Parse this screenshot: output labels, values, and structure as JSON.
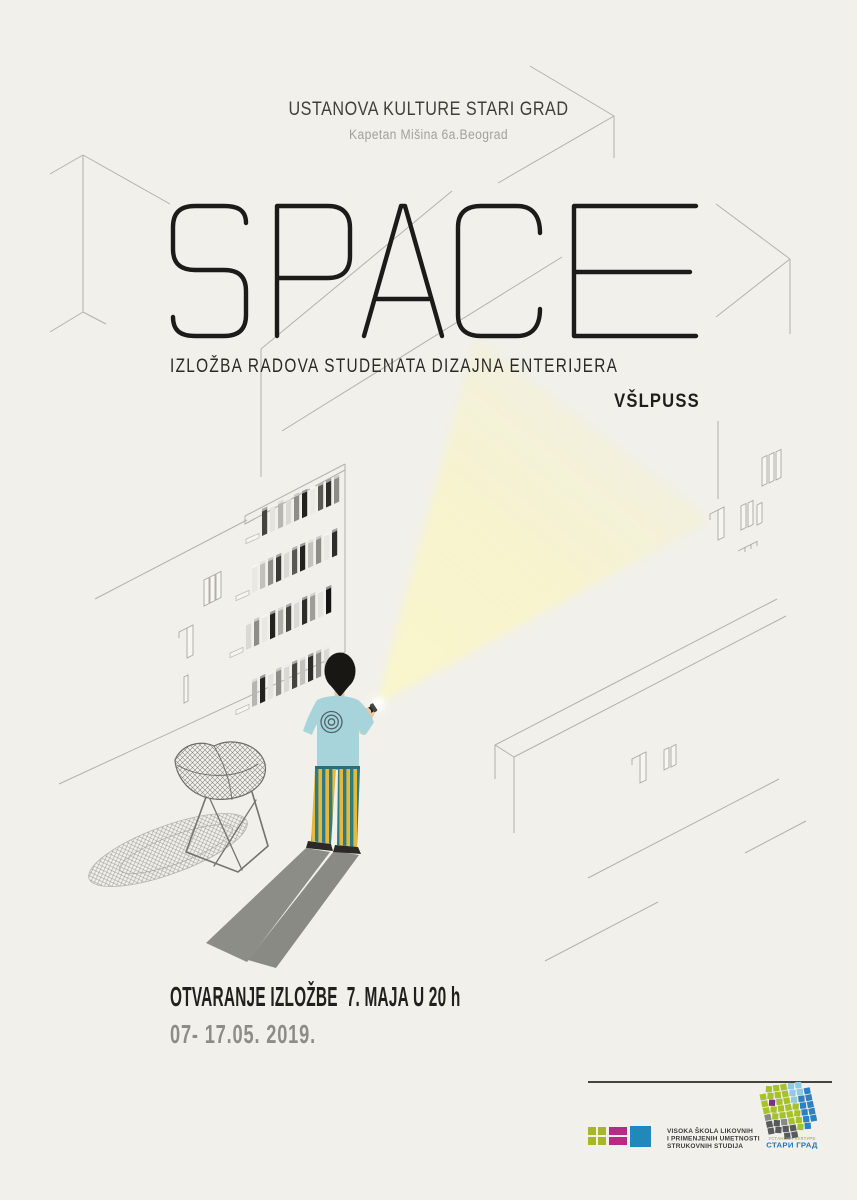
{
  "poster": {
    "venue": "USTANOVA KULTURE STARI GRAD",
    "address": "Kapetan Mišina 6a.Beograd",
    "title": "SPACE",
    "subtitle": "IZLOŽBA RADOVA STUDENATA DIZAJNA ENTERIJERA",
    "organizer": "VŠLPUSS",
    "opening_line": "OTVARANJE IZLOŽBE  7. MAJA U 20 h",
    "dates_line": "07- 17.05. 2019."
  },
  "colors": {
    "background": "#f1f0ea",
    "ink": "#1c1b19",
    "line_gray": "#b3b1ab",
    "muted_text": "#8d8c87",
    "beam_yellow": "#f8f4c8"
  },
  "illustration": {
    "figure": {
      "hair": "#181714",
      "skin": "#e9c79e",
      "shirt": "#a7d4da",
      "emblem_ring": "#4e6367",
      "stripe_teal": "#2a7d84",
      "stripe_yellow": "#e6b93e",
      "shoes": "#2b2a26",
      "shadow": "#8d8d88",
      "flashlight": "#1d1d1b"
    },
    "bookshelf": {
      "rows": [
        {
          "x": 262,
          "y": 536,
          "books": [
            "#45443f",
            "#e4e3de",
            "#b7b6b1",
            "#dad9d4",
            "#8e8d88",
            "#22221e",
            "#ebeae5",
            "#5a5954",
            "#2d2d29",
            "#8e8d88"
          ]
        },
        {
          "x": 252,
          "y": 593,
          "books": [
            "#e9e8e3",
            "#c2c1bc",
            "#8e8d88",
            "#3a3935",
            "#dad9d4",
            "#5a5954",
            "#22221e",
            "#c2c1bc",
            "#8e8d88",
            "#e9e8e3",
            "#2d2d29"
          ]
        },
        {
          "x": 246,
          "y": 650,
          "books": [
            "#dad9d4",
            "#8e8d88",
            "#e9e8e3",
            "#22221e",
            "#aeada8",
            "#45443f",
            "#dad9d4",
            "#2d2d29",
            "#9e9d98",
            "#e4e3de",
            "#141412"
          ]
        },
        {
          "x": 252,
          "y": 707,
          "books": [
            "#b7b6b1",
            "#22221e",
            "#e4e3de",
            "#8e8d88",
            "#dad9d4",
            "#45443f",
            "#c2c1bc",
            "#2d2d29",
            "#8e8d88",
            "#dad9d4"
          ]
        }
      ]
    }
  },
  "logos": {
    "school": {
      "name_lines": [
        "VISOKA ŠKOLA LIKOVNIH",
        "I PRIMENJENIH UMETNOSTI",
        "STRUKOVNIH STUDIJA"
      ],
      "squares": [
        {
          "x": 0,
          "y": 1,
          "w": 8,
          "h": 8,
          "c": "#a9b626"
        },
        {
          "x": 10,
          "y": 1,
          "w": 8,
          "h": 8,
          "c": "#a9b626"
        },
        {
          "x": 0,
          "y": 11,
          "w": 8,
          "h": 8,
          "c": "#a9b626"
        },
        {
          "x": 10,
          "y": 11,
          "w": 8,
          "h": 8,
          "c": "#a9b626"
        },
        {
          "x": 21,
          "y": 1,
          "w": 18,
          "h": 8,
          "c": "#b52c84"
        },
        {
          "x": 21,
          "y": 11,
          "w": 18,
          "h": 8,
          "c": "#b52c84"
        },
        {
          "x": 42,
          "y": 0,
          "w": 21,
          "h": 21,
          "c": "#2089b9"
        }
      ]
    },
    "culture": {
      "name_top": "УСТАНОВА КУЛТУРЕ",
      "name_bottom": "СТАРИ ГРАД",
      "top_color": "#97a233",
      "bottom_color": "#1f77bb",
      "mosaic_palette": {
        "g": "#a5c22e",
        "c": "#8fcbe4",
        "b": "#2e80c0",
        "d": "#58595a",
        "D": "#88898b",
        "P": "#7c2f8a"
      },
      "mosaic_rows": [
        ".gggcc.",
        "ggggccb",
        "gPggcbb",
        "gggggbb",
        "Dggggbb",
        "ddDggbb",
        "ddddgb.",
        "..dd..."
      ]
    }
  }
}
